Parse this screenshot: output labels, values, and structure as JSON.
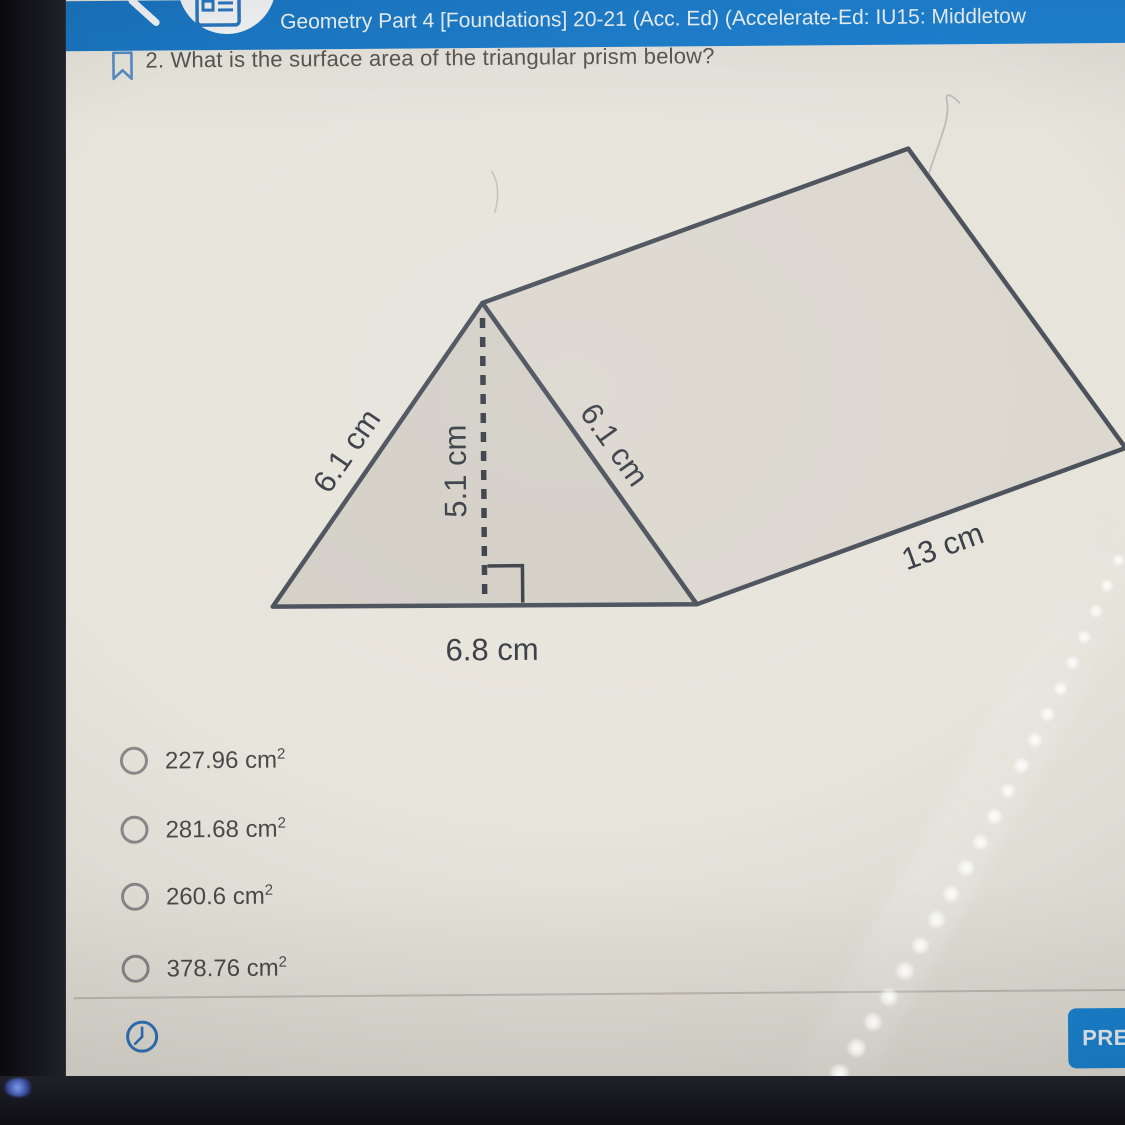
{
  "header": {
    "title": "Geometry Part 4 [Foundations] 20-21 (Acc. Ed) (Accelerate-Ed: IU15: Middletow"
  },
  "question": {
    "text": "2. What is the surface area of the triangular prism below?"
  },
  "diagram": {
    "type": "triangular-prism",
    "labels": {
      "left_side": "6.1 cm",
      "height": "5.1 cm",
      "right_side": "6.1 cm",
      "base": "6.8 cm",
      "length": "13 cm"
    }
  },
  "options": [
    {
      "label": "227.96 cm",
      "sup": "2"
    },
    {
      "label": "281.68 cm",
      "sup": "2"
    },
    {
      "label": "260.6 cm",
      "sup": "2"
    },
    {
      "label": "378.76 cm",
      "sup": "2"
    }
  ],
  "footer": {
    "prev_button": "PRE"
  },
  "colors": {
    "header_blue": "#1e84d6",
    "button_blue": "#1886d8",
    "screen_bg": "#e7e4dc",
    "diagram_line": "#4b515b",
    "front_face_fill": "#d4d0c8",
    "side_face_fill": "#dcd8d0",
    "answer_text": "#4a4a4a",
    "icon_blue": "#2f74bc"
  }
}
